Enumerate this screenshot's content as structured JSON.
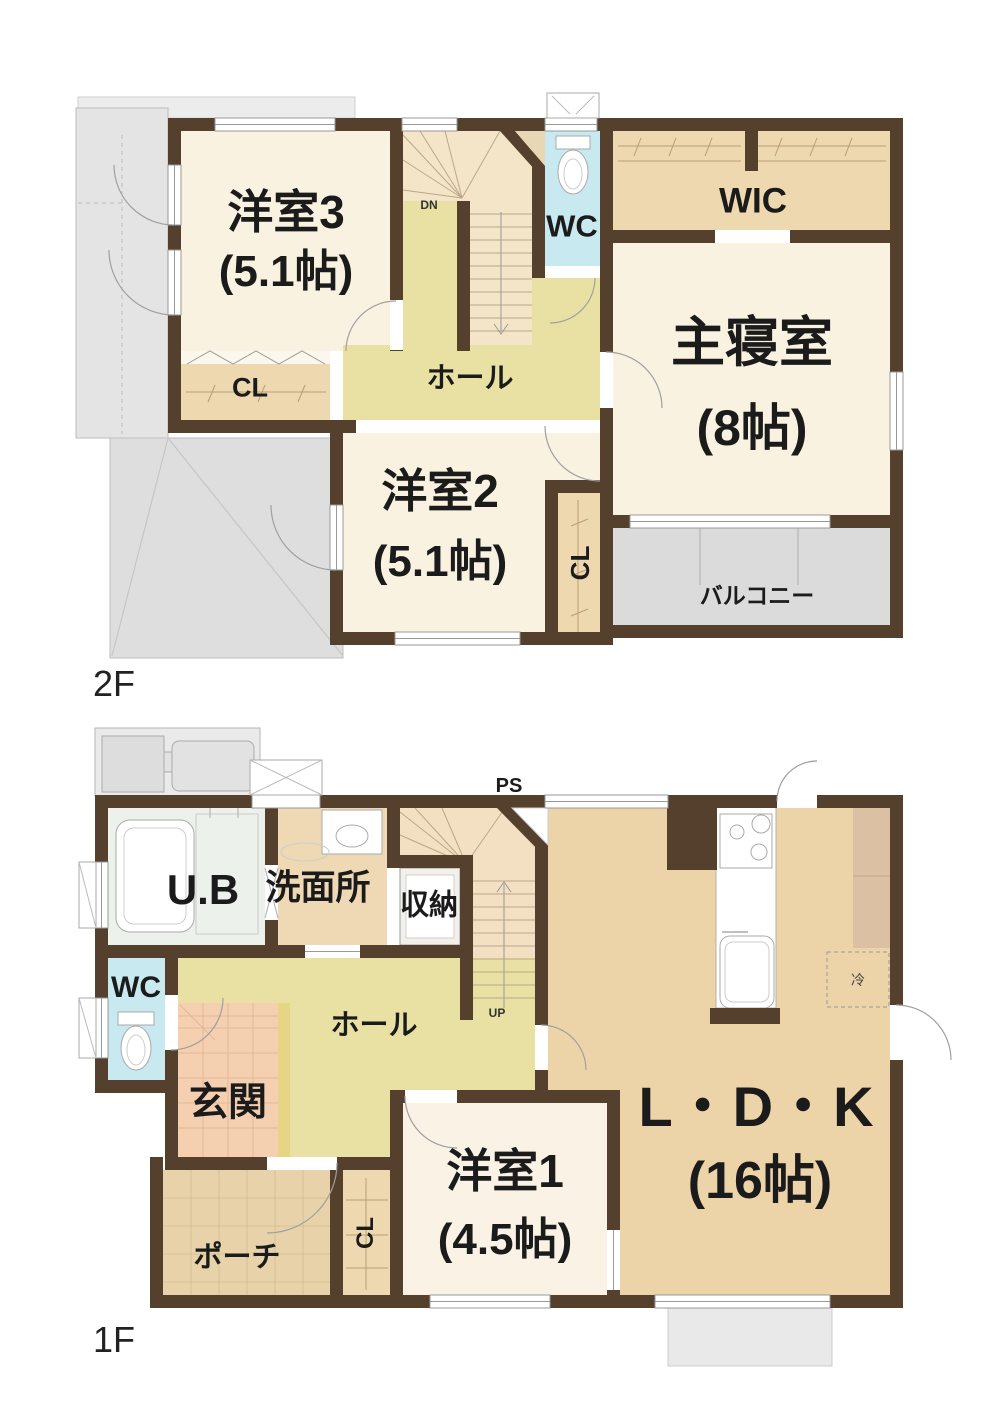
{
  "palette": {
    "wall": "#54402C",
    "room_cream": "#FAF2E0",
    "closet_tan": "#EED8B0",
    "hall_khaki": "#E9E1A4",
    "stair_peach": "#F4E4C8",
    "wc_blue": "#C8E9F0",
    "balcony_gray": "#DBDBDB",
    "roof_gray": "#E2E2E2",
    "ldk_tan": "#EDD3A8",
    "genkan_pink": "#F4CFB0",
    "porch_tan": "#E7D2A9",
    "ub_green": "#ECF1EB",
    "text": "#1B1B1B"
  },
  "floor2": {
    "floor_label": "2F",
    "stair_label": "DN",
    "rooms": {
      "yoshitsu3": {
        "name": "洋室3",
        "size": "(5.1帖)"
      },
      "cl": {
        "name": "CL"
      },
      "hall": {
        "name": "ホール"
      },
      "wc": {
        "name": "WC"
      },
      "wic": {
        "name": "WIC"
      },
      "shushinshitsu": {
        "name": "主寝室",
        "size": "(8帖)"
      },
      "yoshitsu2": {
        "name": "洋室2",
        "size": "(5.1帖)"
      },
      "cl_vertical": {
        "name": "CL"
      },
      "balcony": {
        "name": "バルコニー"
      }
    }
  },
  "floor1": {
    "floor_label": "1F",
    "stair_label": "UP",
    "ps_label": "PS",
    "fridge_label": "冷",
    "rooms": {
      "ub": {
        "name": "U.B"
      },
      "senmenjo": {
        "name": "洗面所"
      },
      "shuno": {
        "name": "収納"
      },
      "wc": {
        "name": "WC"
      },
      "hall": {
        "name": "ホール"
      },
      "genkan": {
        "name": "玄関"
      },
      "porch": {
        "name": "ポーチ"
      },
      "cl_vertical": {
        "name": "CL"
      },
      "yoshitsu1": {
        "name": "洋室1",
        "size": "(4.5帖)"
      },
      "ldk": {
        "name": "L・D・K",
        "size": "(16帖)"
      }
    }
  }
}
